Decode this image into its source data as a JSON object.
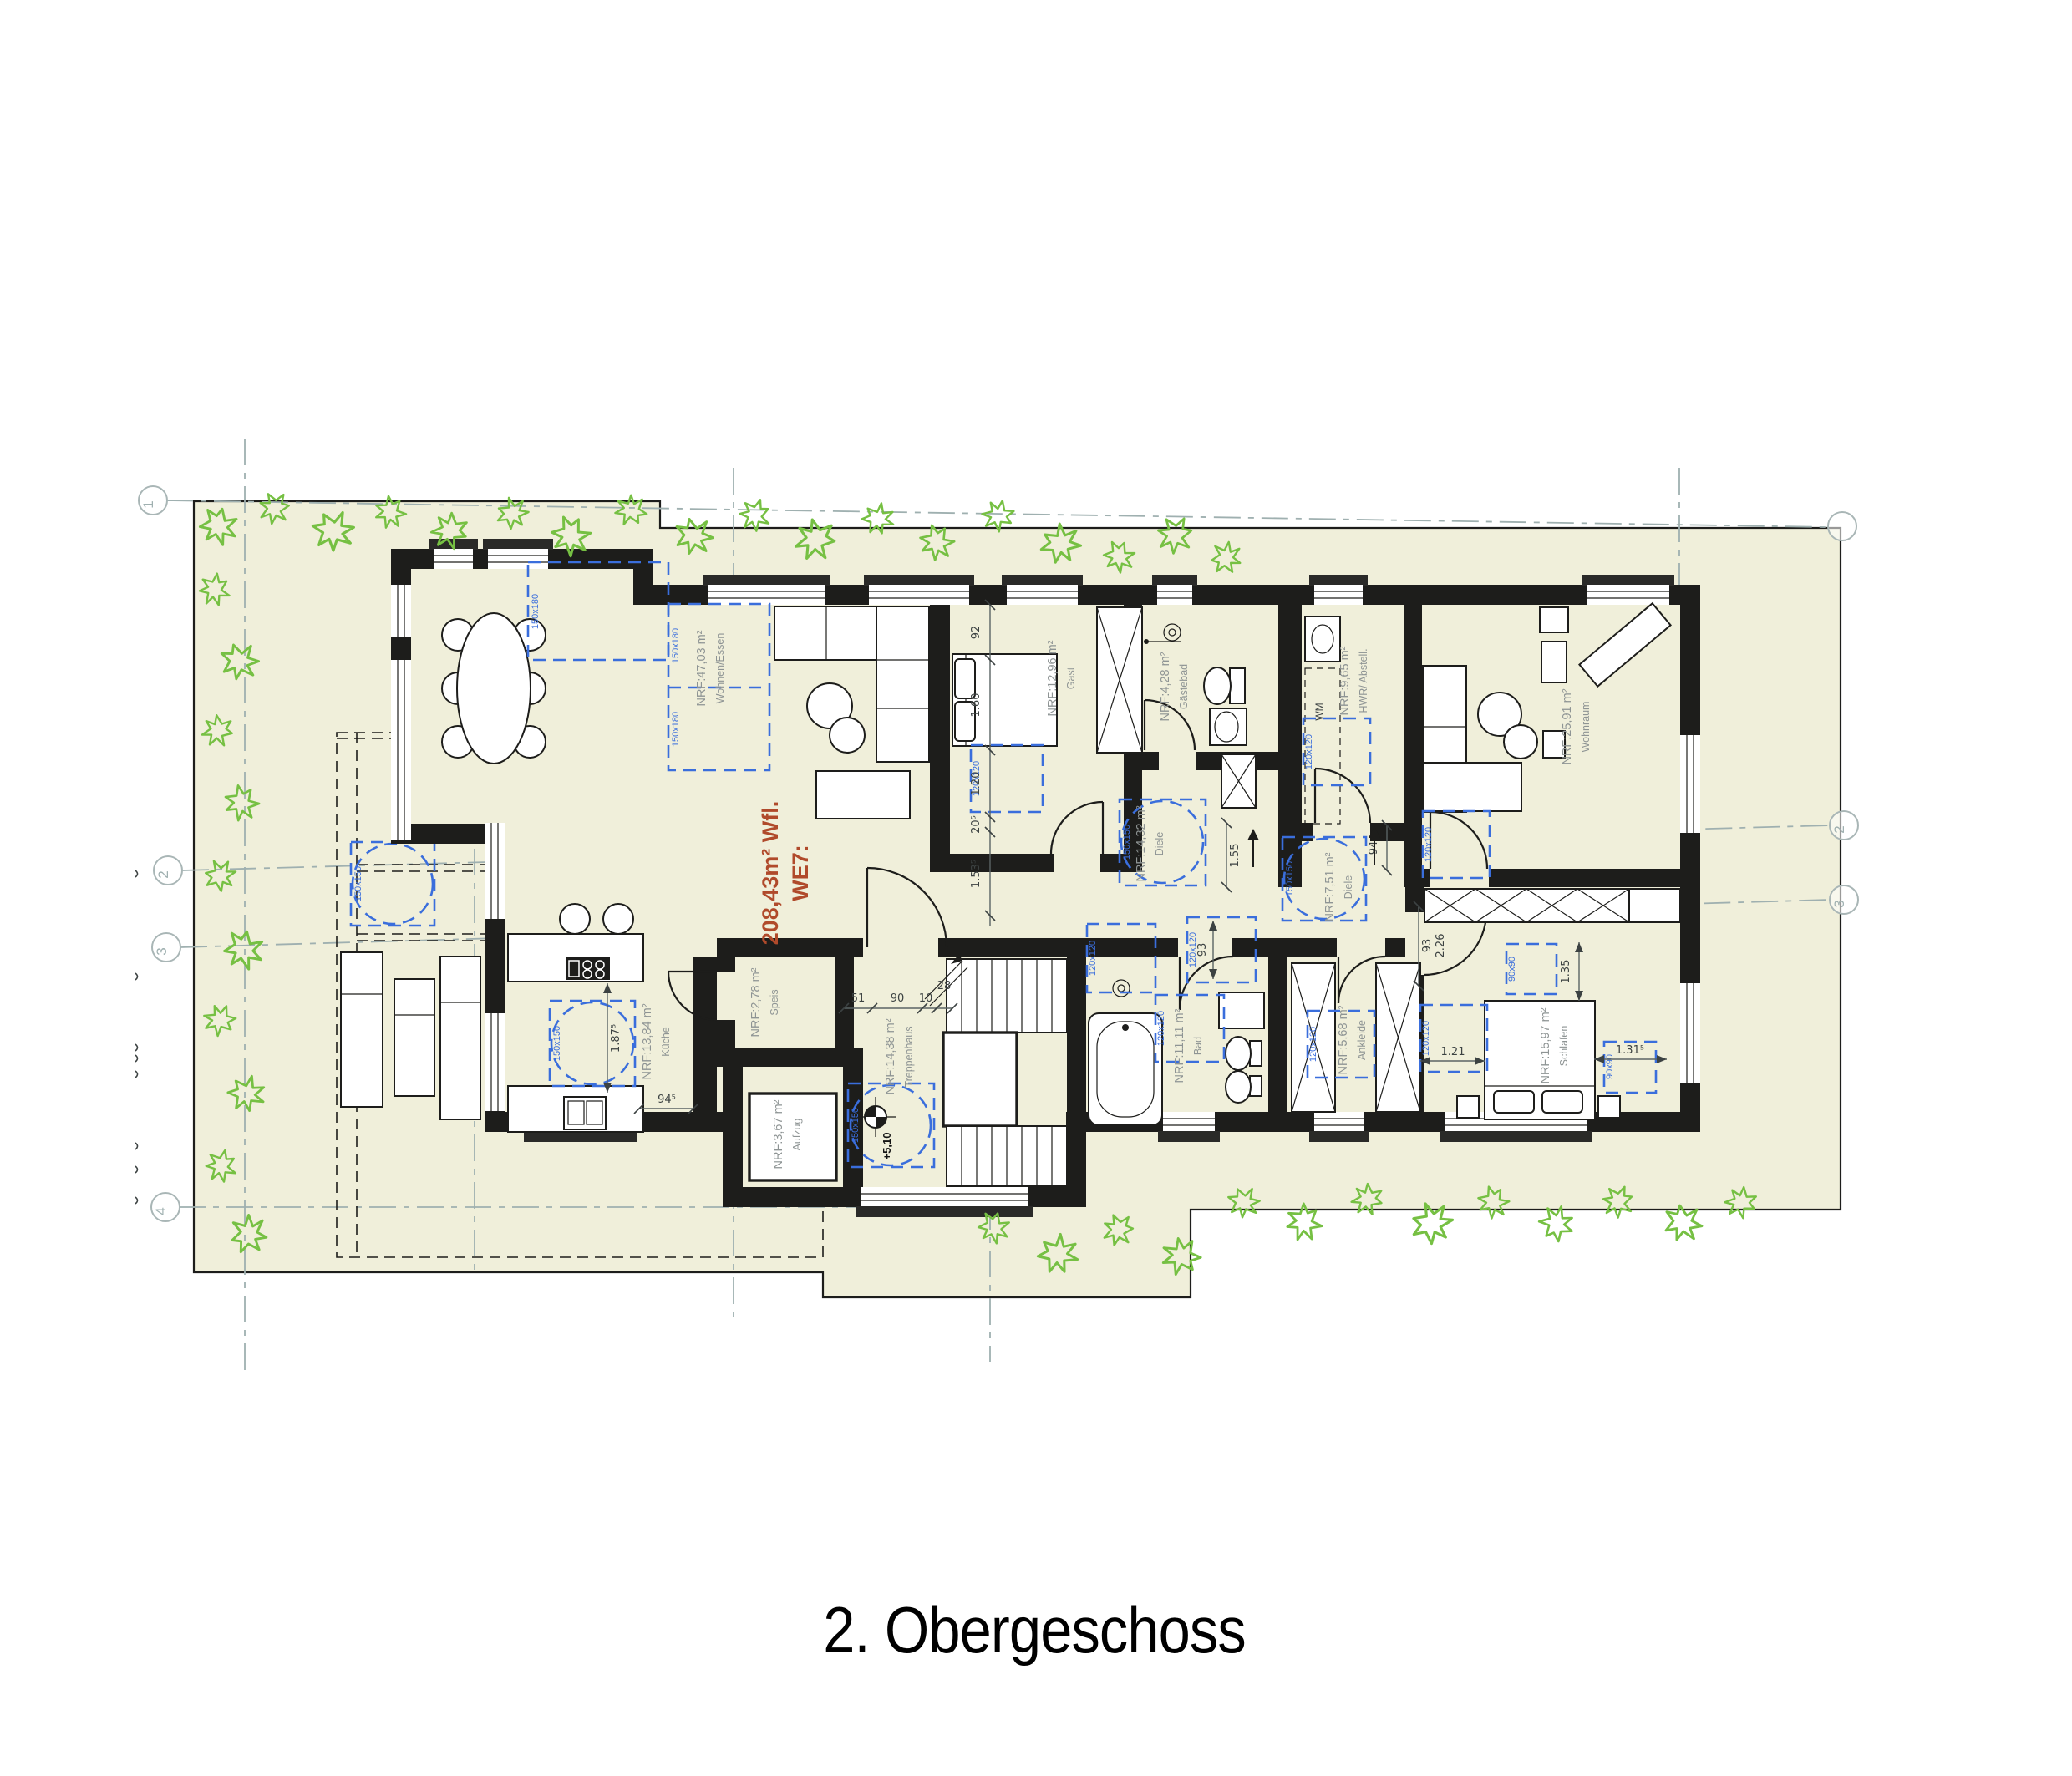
{
  "title": "2. Obergeschoss",
  "apartment": {
    "name": "WE7:",
    "area": "208,43m² Wfl."
  },
  "rooms": [
    {
      "name": "Terrasse",
      "area": "NRF:149,55 m²"
    },
    {
      "name": "Wohnen/Essen",
      "area": "NRF:47,03 m²"
    },
    {
      "name": "Gast",
      "area": "NRF:12,96 m²"
    },
    {
      "name": "Gästebad",
      "area": "NRF:4,28 m²"
    },
    {
      "name": "HWR/ Abstell.",
      "area": "NRF:9,65 m²"
    },
    {
      "name": "Wohnraum",
      "area": "NRF:25,91 m²"
    },
    {
      "name": "Diele",
      "area": "NRF:14,32 m²"
    },
    {
      "name": "Diele",
      "area": "NRF:7,51 m²"
    },
    {
      "name": "Küche",
      "area": "NRF:13,84 m²"
    },
    {
      "name": "Speis",
      "area": "NRF:2,78 m²"
    },
    {
      "name": "Aufzug",
      "area": "NRF:3,67 m²"
    },
    {
      "name": "Treppenhaus",
      "area": "NRF:14,38 m²"
    },
    {
      "name": "Bad",
      "area": "NRF:11,11 m²"
    },
    {
      "name": "Ankleide",
      "area": "NRF:5,68 m²"
    },
    {
      "name": "Schlafen",
      "area": "NRF:15,97 m²"
    }
  ],
  "dims": {
    "w92": "92",
    "w160": "1.60",
    "w120": "1.20",
    "w205": "20⁵",
    "w1535": "1.53⁵",
    "w155": "1.55",
    "door94": "94",
    "s51": "51",
    "s90": "90",
    "s10": "10",
    "s28": "28",
    "k945": "94⁵",
    "k1875": "1.87⁵",
    "b93": "93",
    "sch226": "2.26",
    "sch93": "93",
    "sch135": "1.35",
    "sch121": "1.21",
    "sch1315": "1.31⁵"
  },
  "markers": {
    "level": "+5,10",
    "wm": "WM",
    "m150x180": "150x180",
    "m150x150": "150x150",
    "m120x120": "120x120",
    "m90x90": "90x90"
  },
  "grid": {
    "l1": "1",
    "l2": "2",
    "l3": "3",
    "l4": "4",
    "r2": "2",
    "r3": "3"
  },
  "colors": {
    "site": "#f0efda",
    "wall": "#1d1d1b",
    "accent_blue": "#3a6edc",
    "accent_green": "#76c043",
    "accent_red": "#b04a2b",
    "label_gray": "#8e9494",
    "grid_gray": "#a9b6b6"
  }
}
